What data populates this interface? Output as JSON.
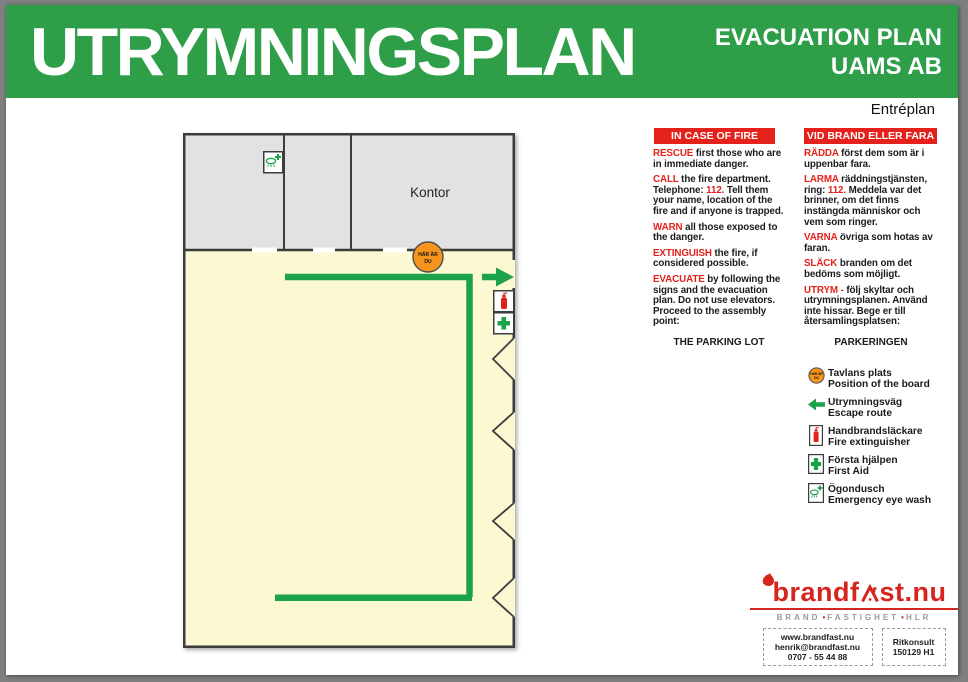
{
  "header": {
    "title": "UTRYMNINGSPLAN",
    "subtitle1": "EVACUATION PLAN",
    "subtitle2": "UAMS AB"
  },
  "plan_label": "Entréplan",
  "floor_plan": {
    "room_label": "Kontor",
    "marker": {
      "line1": "HÄR ÄR",
      "line2": "DU"
    }
  },
  "instructions_en": {
    "header": "IN CASE OF FIRE",
    "paragraphs": [
      [
        {
          "t": "RESCUE",
          "red": true
        },
        {
          "t": " first those who are in immediate danger.",
          "red": false
        }
      ],
      [
        {
          "t": "CALL",
          "red": true
        },
        {
          "t": " the fire department. Telephone: ",
          "red": false
        },
        {
          "t": "112.",
          "red": true
        },
        {
          "t": " Tell them your name, location of the fire and if anyone is trapped.",
          "red": false
        }
      ],
      [
        {
          "t": "WARN",
          "red": true
        },
        {
          "t": " all those exposed to the danger.",
          "red": false
        }
      ],
      [
        {
          "t": "EXTINGUISH",
          "red": true
        },
        {
          "t": " the fire, if considered possible.",
          "red": false
        }
      ],
      [
        {
          "t": "EVACUATE",
          "red": true
        },
        {
          "t": " by following the signs and the evacuation plan. Do not use elevators. Proceed to the assembly point:",
          "red": false
        }
      ]
    ],
    "assembly_point": "THE PARKING LOT"
  },
  "instructions_sv": {
    "header": "VID BRAND ELLER FARA",
    "paragraphs": [
      [
        {
          "t": "RÄDDA",
          "red": true
        },
        {
          "t": " först dem som är i uppenbar fara.",
          "red": false
        }
      ],
      [
        {
          "t": "LARMA",
          "red": true
        },
        {
          "t": " räddningstjänsten, ring: ",
          "red": false
        },
        {
          "t": "112.",
          "red": true
        },
        {
          "t": " Meddela var det brinner, om det finns instängda människor och vem som ringer.",
          "red": false
        }
      ],
      [
        {
          "t": "VARNA",
          "red": true
        },
        {
          "t": " övriga som hotas av faran.",
          "red": false
        }
      ],
      [
        {
          "t": "SLÄCK",
          "red": true
        },
        {
          "t": " branden om det bedöms som möjligt.",
          "red": false
        }
      ],
      [
        {
          "t": "UTRYM -",
          "red": true
        },
        {
          "t": " följ skyltar och utrymningsplanen. Använd inte hissar. Bege er till återsamlingsplatsen:",
          "red": false
        }
      ]
    ],
    "assembly_point": "PARKERINGEN"
  },
  "legend": {
    "items": [
      {
        "icon": "you-are-here-icon",
        "line1": "Tavlans plats",
        "line2": "Position of the board"
      },
      {
        "icon": "escape-route-arrow-icon",
        "line1": "Utrymningsväg",
        "line2": "Escape route"
      },
      {
        "icon": "fire-extinguisher-icon",
        "line1": "Handbrandsläckare",
        "line2": "Fire extinguisher"
      },
      {
        "icon": "first-aid-icon",
        "line1": "Första hjälpen",
        "line2": "First Aid"
      },
      {
        "icon": "eye-wash-icon",
        "line1": "Ögondusch",
        "line2": "Emergency eye wash"
      }
    ]
  },
  "footer": {
    "logo": {
      "part1": "brandf",
      "part2": "st.nu"
    },
    "tagline": {
      "words": [
        "BRAND",
        "FASTIGHET",
        "HLR"
      ],
      "separator": "•"
    },
    "contact": {
      "website": "www.brandfast.nu",
      "email": "henrik@brandfast.nu",
      "phone": "0707 - 55 44 88"
    },
    "ref": {
      "line1": "Ritkonsult",
      "line2": "150129 H1"
    }
  },
  "colors": {
    "banner_green": "#2e9e49",
    "route_green": "#1ca34a",
    "alert_red": "#e4221b",
    "marker_orange": "#f7941d",
    "floor_yellow": "#fbf8d2",
    "room_gray": "#e2e2e4",
    "logo_red": "#d6251e"
  }
}
